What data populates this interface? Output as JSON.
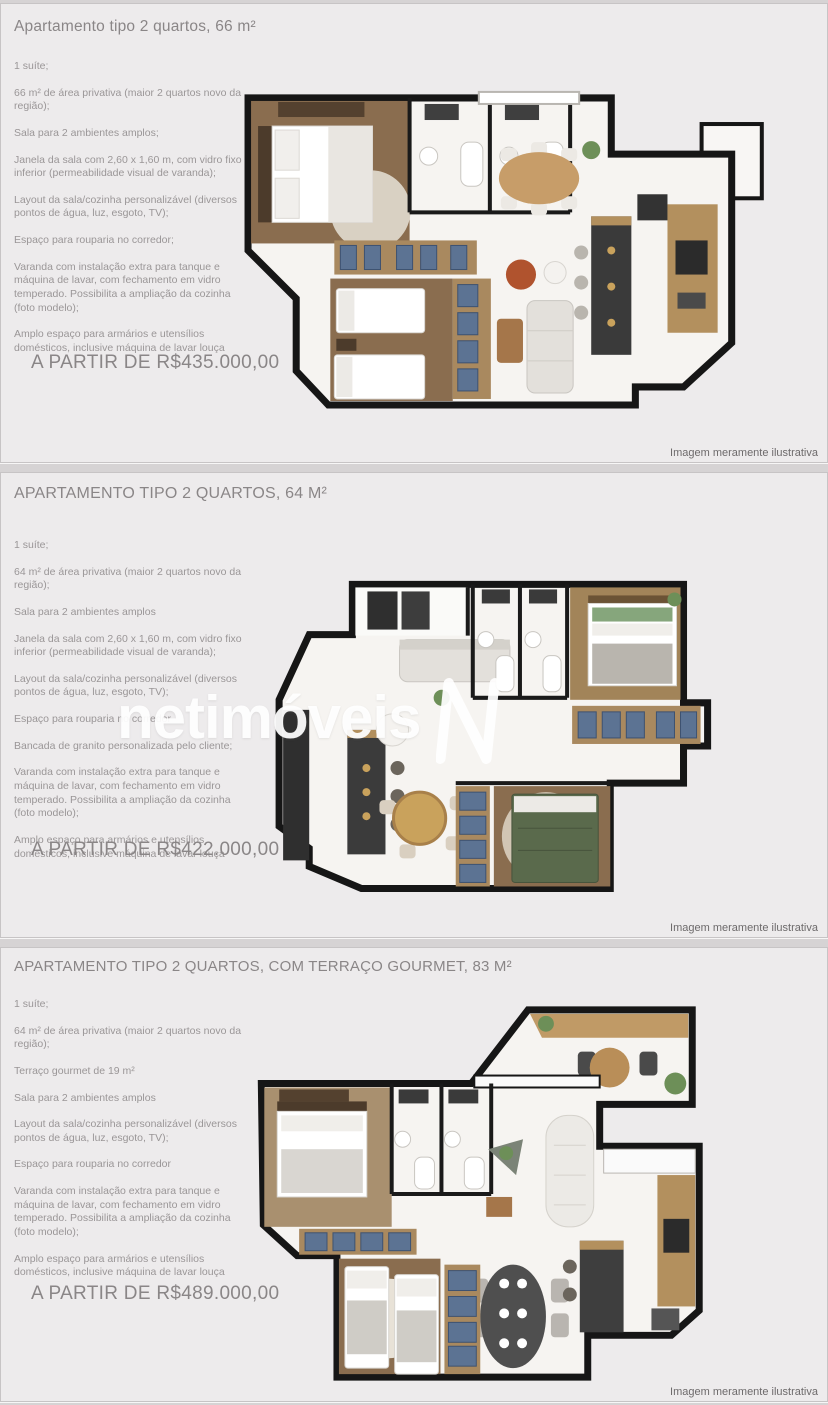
{
  "disclaimer": "Imagem meramente ilustrativa",
  "watermark": {
    "text": "netimóveis",
    "logo": "netimoveis-n-monogram"
  },
  "colors": {
    "card_bg": "#edebec",
    "title_text": "#8a8687",
    "body_text": "#9a9697",
    "wall": "#161616",
    "wood_floor": "#8a6d4f",
    "drawer_blue": "#5c7393",
    "counter_dark": "#3a3a3a",
    "wood_furniture": "#b3905e",
    "accent_terracotta": "#b0532e",
    "watermark_white": "#ffffff"
  },
  "sections": [
    {
      "title": "Apartamento tipo 2 quartos, 66 m²",
      "bullets": [
        "1 suíte;",
        "66 m² de área privativa (maior 2 quartos novo da região);",
        "Sala para 2 ambientes amplos;",
        "Janela da sala com 2,60 x 1,60 m, com vidro fixo inferior (permeabilidade visual de varanda);",
        "Layout da sala/cozinha personalizável (diversos pontos de água, luz, esgoto, TV);",
        "Espaço para rouparia no corredor;",
        "Varanda com instalação extra para tanque e máquina de lavar, com fechamento em vidro temperado. Possibilita a ampliação da cozinha (foto modelo);",
        "Amplo espaço para armários e utensílios domésticos, inclusive máquina de lavar louça"
      ],
      "price": "A PARTIR DE R$435.000,00"
    },
    {
      "title": "APARTAMENTO TIPO 2 QUARTOS, 64 M²",
      "bullets": [
        "1 suíte;",
        "64 m² de área privativa (maior 2 quartos novo da região);",
        "Sala para 2 ambientes amplos",
        "Janela da sala com 2,60 x 1,60 m, com vidro fixo inferior (permeabilidade visual de varanda);",
        "Layout da sala/cozinha personalizável (diversos pontos de água, luz, esgoto, TV);",
        "Espaço para rouparia no corredor",
        "Bancada de granito personalizada pelo cliente;",
        "Varanda com instalação extra para tanque e máquina de lavar, com fechamento em vidro temperado. Possibilita a ampliação da cozinha (foto modelo);",
        "Amplo espaço para armários e utensílios domésticos, inclusive máquina de lavar louça"
      ],
      "price": "A PARTIR DE R$422.000,00"
    },
    {
      "title": "APARTAMENTO TIPO 2 QUARTOS, COM TERRAÇO GOURMET, 83 M²",
      "bullets": [
        "1 suíte;",
        "64 m² de área privativa (maior 2 quartos novo da região);",
        "Terraço gourmet de 19 m²",
        "Sala para 2 ambientes amplos",
        "Layout da sala/cozinha personalizável (diversos pontos de água, luz, esgoto, TV);",
        "Espaço para rouparia no corredor",
        "Varanda com instalação extra para tanque e máquina de lavar, com fechamento em vidro temperado. Possibilita a ampliação da cozinha (foto modelo);",
        "Amplo espaço para armários e utensílios domésticos, inclusive máquina de lavar louça"
      ],
      "price": "A PARTIR DE R$489.000,00"
    }
  ]
}
